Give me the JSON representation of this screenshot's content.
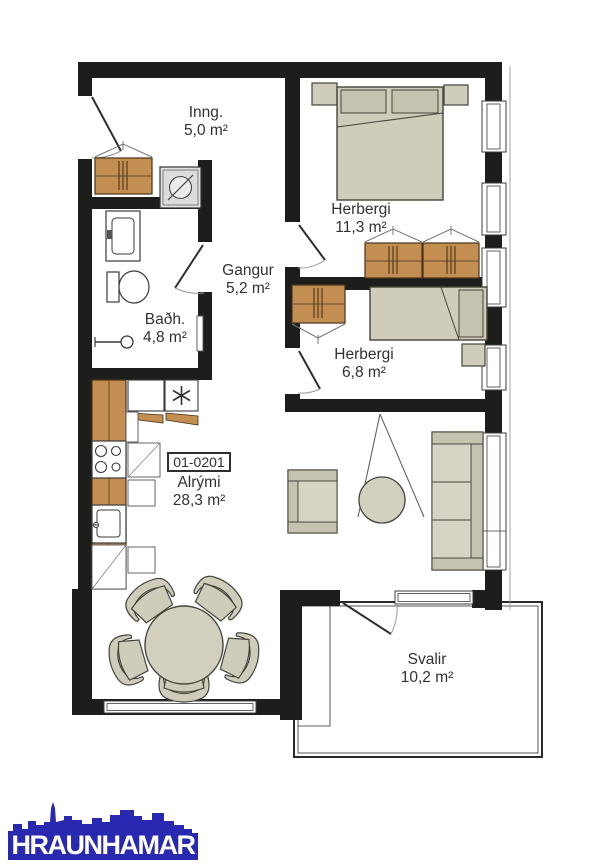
{
  "plan": {
    "unit_number": "01-0201",
    "rooms": [
      {
        "id": "inng",
        "name": "Inng.",
        "area": "5,0 m²"
      },
      {
        "id": "herbergi1",
        "name": "Herbergi",
        "area": "11,3 m²"
      },
      {
        "id": "gangur",
        "name": "Gangur",
        "area": "5,2 m²"
      },
      {
        "id": "badh",
        "name": "Baðh.",
        "area": "4,8 m²"
      },
      {
        "id": "herbergi2",
        "name": "Herbergi",
        "area": "6,8 m²"
      },
      {
        "id": "alrymi",
        "name": "Alrými",
        "area": "28,3 m²"
      },
      {
        "id": "svalir",
        "name": "Svalir",
        "area": "10,2 m²"
      }
    ],
    "colors": {
      "wall": "#1d1d1b",
      "wood": "#c28e52",
      "furniture": "#cfccbc",
      "logo_blue": "#2828b0"
    },
    "icons": {
      "freezer_symbol": "✳",
      "washing_machine": "drum-circle-with-slash",
      "shower": "shower-head"
    }
  },
  "logo": {
    "text": "HRAUNHAMAR"
  }
}
